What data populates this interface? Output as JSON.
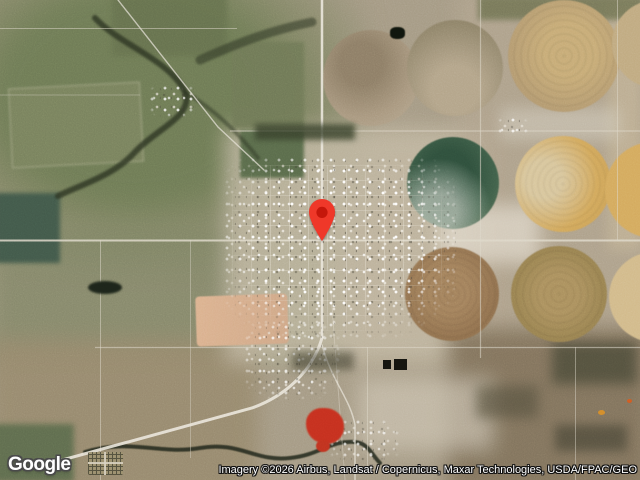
{
  "map": {
    "view": "satellite",
    "marker": {
      "label": "location-pin",
      "fill": "#EF3829",
      "dot": "#C5170B"
    }
  },
  "branding": {
    "logo": "Google"
  },
  "attribution": {
    "text": "Imagery ©2026 Airbus, Landsat / Copernicus, Maxar Technologies, USDA/FPAC/GEO"
  }
}
